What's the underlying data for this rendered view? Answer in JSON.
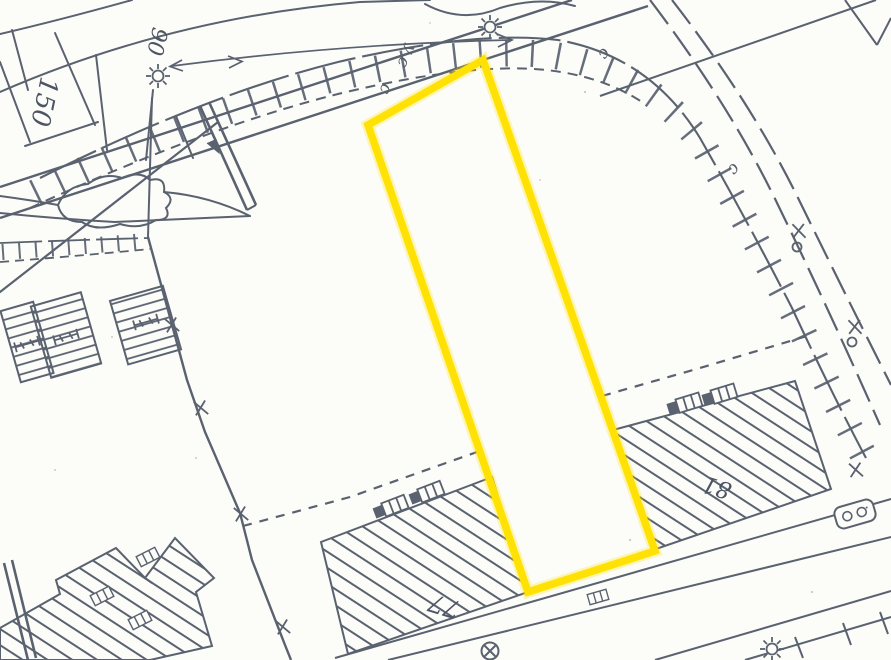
{
  "map": {
    "type": "cadastral-plan-scan",
    "highlight_color": "#FFE104",
    "line_color": "#5a6270",
    "labels": {
      "parcel_150": "150",
      "street_90": "90",
      "building_77": "77",
      "building_81": "81",
      "partial_bottom": "81"
    },
    "letters": {
      "c1": "c",
      "c2": "c",
      "y1": "y",
      "c3": "c",
      "c4": "c"
    }
  }
}
